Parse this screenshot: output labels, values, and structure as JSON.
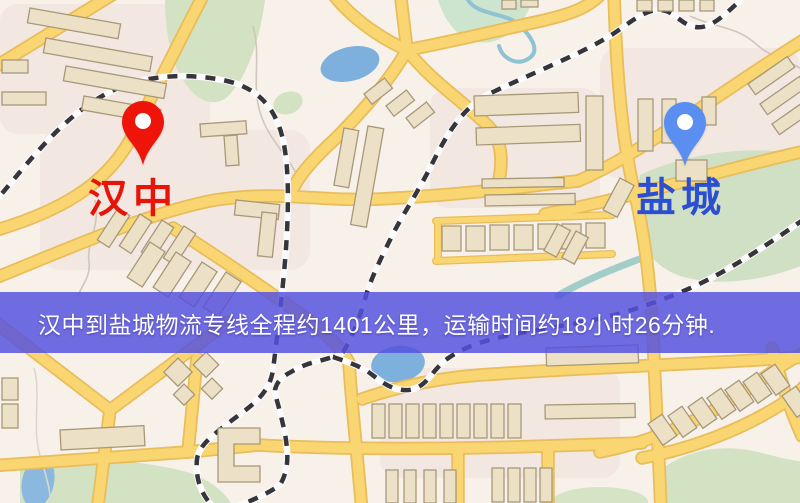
{
  "banner": {
    "text": "汉中到盐城物流专线全程约1401公里，运输时间约18小时26分钟.",
    "bg_color": "#5551df",
    "text_color": "#ffffff"
  },
  "markers": {
    "origin": {
      "label": "汉中",
      "label_color": "#e81408",
      "pin_color": "#ee1409"
    },
    "destination": {
      "label": "盐城",
      "label_color": "#2b4ed2",
      "pin_color": "#5a8ef0"
    }
  },
  "map_colors": {
    "background": "#f7f1ea",
    "road_fill": "#f9d672",
    "road_casing": "#e8bd5a",
    "railway_dash": "#35353b",
    "building_fill": "#ece1c6",
    "building_stroke": "#a79878",
    "park_green": "#d2e2c2",
    "water_blue": "#7db0dc",
    "residential_pink": "#f1dfdb"
  }
}
